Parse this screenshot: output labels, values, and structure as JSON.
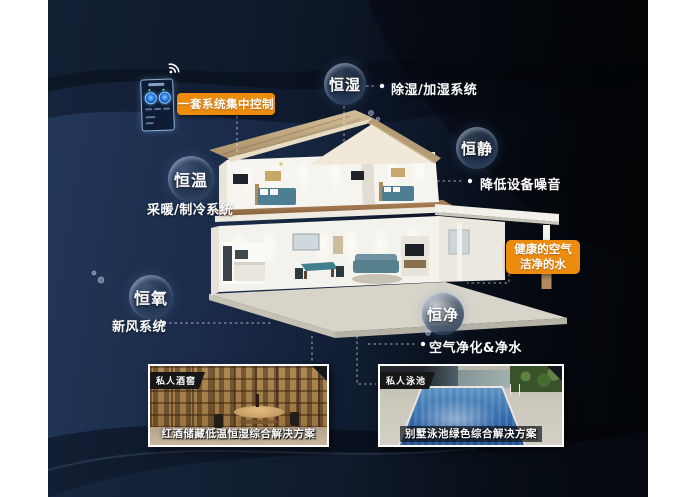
{
  "features": [
    {
      "id": "humidity",
      "bubble": "恒湿",
      "note": "除湿/加湿系统"
    },
    {
      "id": "quiet",
      "bubble": "恒静",
      "note": "降低设备噪音"
    },
    {
      "id": "temperature",
      "bubble": "恒温",
      "note": "采暖/制冷系统"
    },
    {
      "id": "oxygen",
      "bubble": "恒氧",
      "note": "新风系统"
    },
    {
      "id": "purity",
      "bubble": "恒净",
      "note": "空气净化&净水"
    }
  ],
  "callouts": {
    "central_control": "一套系统集中控制",
    "healthy_line1": "健康的空气",
    "healthy_line2": "洁净的水"
  },
  "cards": [
    {
      "badge": "私人酒窖",
      "caption": "红酒储藏低温恒湿综合解决方案"
    },
    {
      "badge": "私人泳池",
      "caption": "别墅泳池绿色综合解决方案"
    }
  ],
  "icons": {
    "wifi": "wifi-signal",
    "control_panel": "smart-home-control-panel"
  },
  "colors": {
    "accent_orange": "#ec8b0e",
    "panel_navy": "#24385c",
    "panel_black": "#04070b",
    "bubble_text": "#ffffff"
  }
}
